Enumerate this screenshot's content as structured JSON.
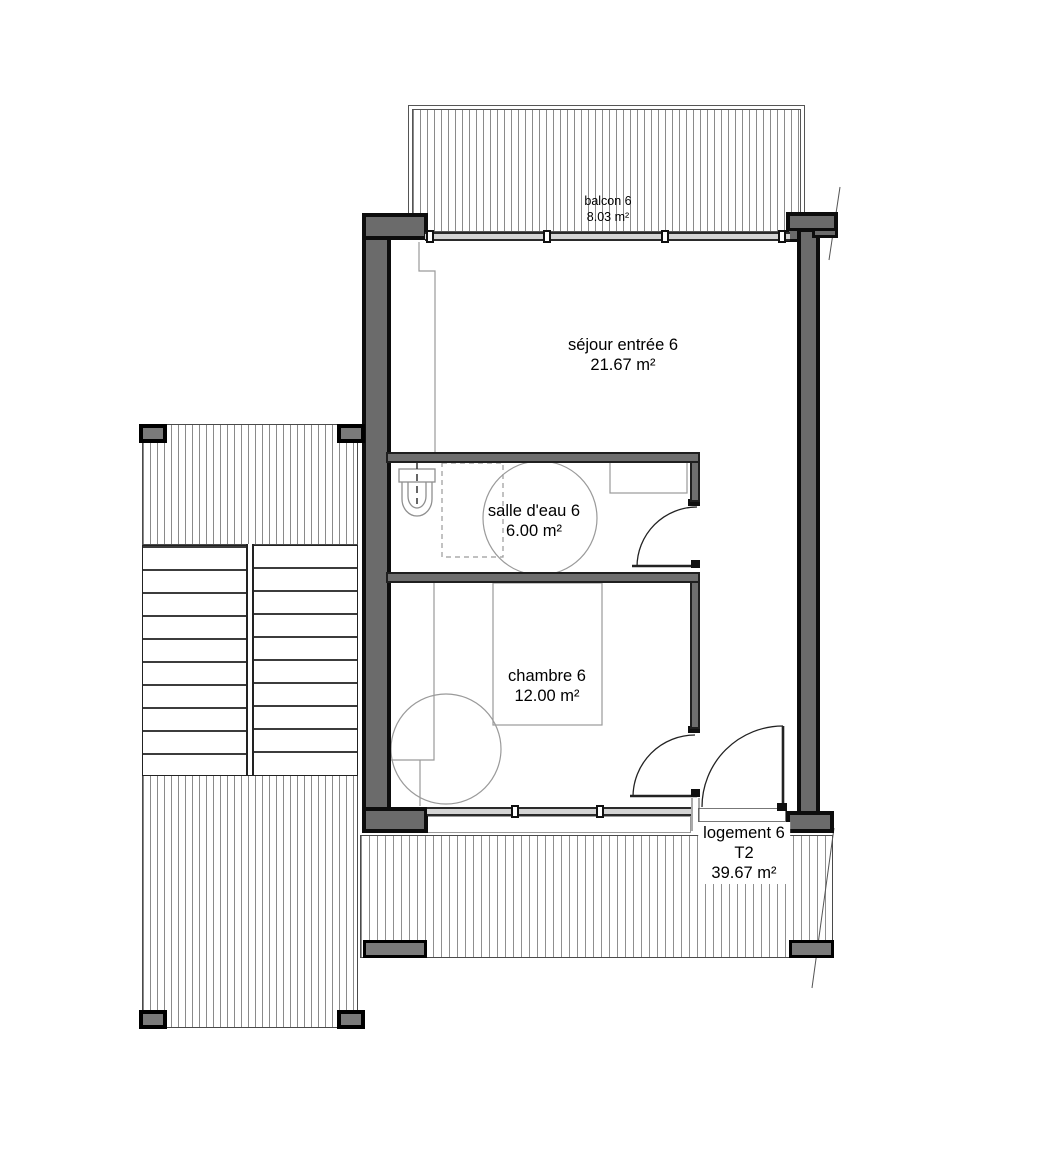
{
  "drawing": {
    "type": "architectural-floor-plan",
    "rooms": [
      {
        "id": "balcon",
        "label": "balcon 6",
        "area": "8.03 m²"
      },
      {
        "id": "sejour",
        "label": "séjour entrée 6",
        "area": "21.67 m²"
      },
      {
        "id": "salle_eau",
        "label": "salle d'eau 6",
        "area": "6.00 m²"
      },
      {
        "id": "chambre",
        "label": "chambre 6",
        "area": "12.00 m²"
      }
    ],
    "unit": {
      "label": "logement 6",
      "type": "T2",
      "area": "39.67 m²"
    },
    "colors": {
      "wall_fill": "#6b6b6b",
      "wall_outline": "#0d0d0d",
      "partition_fill": "#6e6e6e",
      "hatch_line": "#8a8a8a",
      "furniture_line": "#9a9a9a",
      "door_line": "#222222",
      "glazing_fill": "#d4d4d4"
    }
  }
}
